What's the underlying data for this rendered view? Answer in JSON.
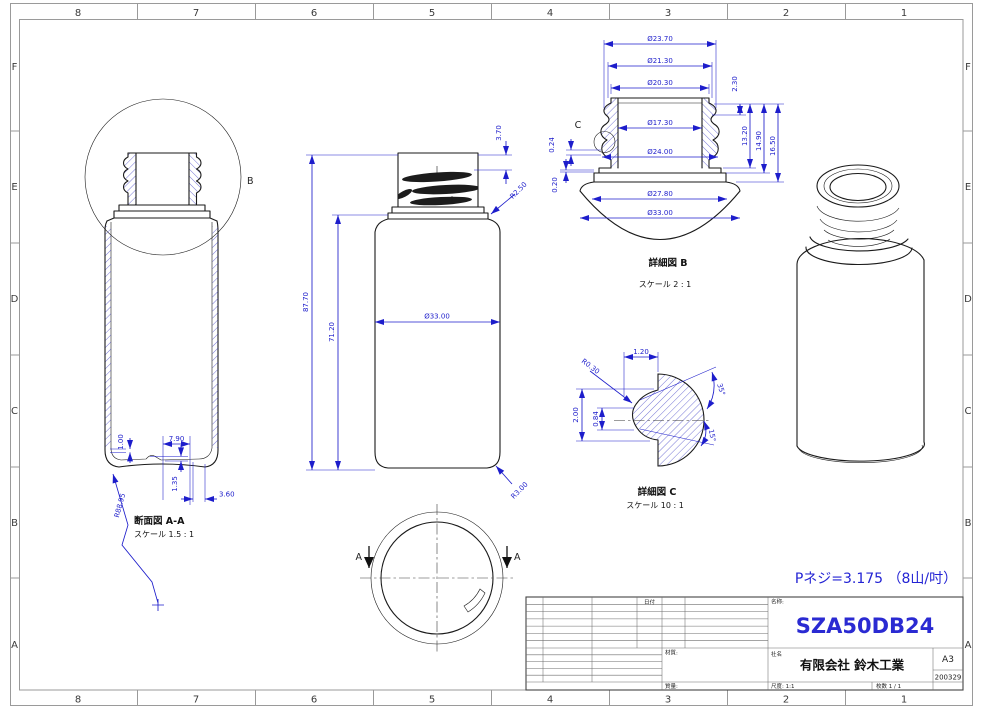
{
  "border": {
    "columns": [
      "8",
      "7",
      "6",
      "5",
      "4",
      "3",
      "2",
      "1"
    ],
    "rows": [
      "F",
      "E",
      "D",
      "C",
      "B",
      "A"
    ]
  },
  "section_view": {
    "title": "断面図 A-A",
    "scale": "スケール 1.5 : 1",
    "detail_marker": "B",
    "dims": {
      "wall": "1.00",
      "width": "7.90",
      "pushup": "1.35",
      "edge": "3.60",
      "radius": "R88.95"
    }
  },
  "front_view": {
    "dims": {
      "total_height": "87.70",
      "body_height": "71.20",
      "body_dia": "Ø33.00",
      "neck_top": "3.70",
      "shoulder_radius": "R2.50",
      "base_radius": "R3.00"
    }
  },
  "bottom_view": {
    "cut_label": "A"
  },
  "detail_b": {
    "title": "詳細図 B",
    "scale": "スケール 2 : 1",
    "detail_marker": "C",
    "dims": {
      "dia1": "Ø23.70",
      "dia2": "Ø21.30",
      "dia3": "Ø20.30",
      "dia4": "Ø17.30",
      "dia5": "Ø24.00",
      "dia6": "Ø27.80",
      "dia7": "Ø33.00",
      "h1": "2.30",
      "h2": "13.20",
      "h3": "14.90",
      "h4": "16.50",
      "t1": "0.24",
      "t2": "0.20"
    }
  },
  "detail_c": {
    "title": "詳細図 C",
    "scale": "スケール 10 : 1",
    "dims": {
      "width": "1.20",
      "tip_radius": "R0.30",
      "height": "2.00",
      "inner": "0.84",
      "angle1": "35°",
      "angle2": "15°"
    }
  },
  "thread_note": "Pネジ=3.175 （8山/吋）",
  "title_block": {
    "date_header": "日付",
    "name_label": "名称:",
    "part_number": "SZA50DB24",
    "material_label": "材質:",
    "company_label": "社名",
    "company": "有限会社 鈴木工業",
    "sheet_size": "A3",
    "drawing_number": "200329",
    "mass_label": "質量:",
    "scale_label": "尺度: 1:1",
    "sheet_count": "枚数 1 / 1"
  },
  "colors": {
    "dimension_blue": "#1d1dcb",
    "part_number_blue": "#2a2ad2",
    "line_black": "#1a1a1a"
  }
}
